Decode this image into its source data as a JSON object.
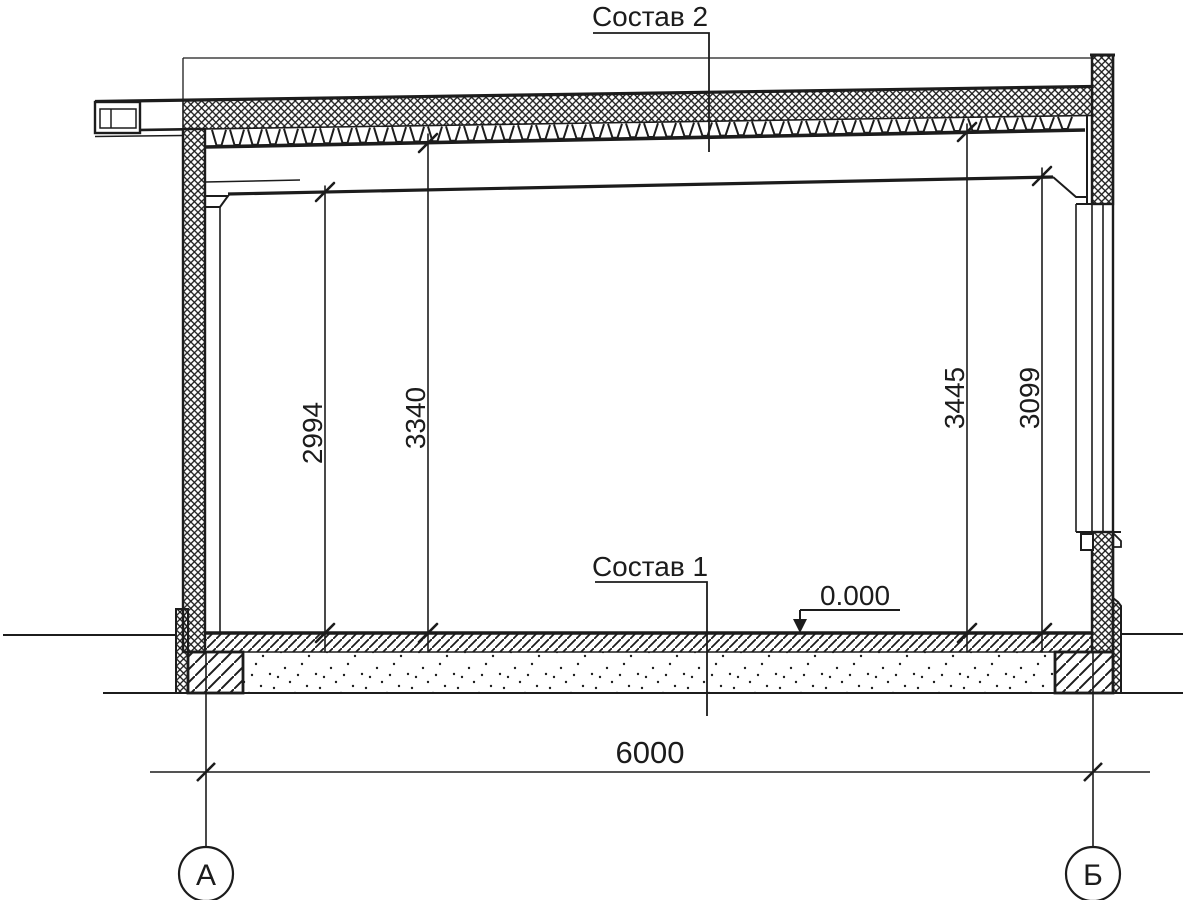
{
  "drawing": {
    "type": "building-section",
    "callouts": {
      "roof_assembly": "Состав 2",
      "floor_assembly": "Состав 1"
    },
    "level_mark": {
      "value": "0.000"
    },
    "dimensions": {
      "overall_width": {
        "value": "6000"
      },
      "vertical": [
        {
          "value": "2994"
        },
        {
          "value": "3340"
        },
        {
          "value": "3445"
        },
        {
          "value": "3099"
        }
      ]
    },
    "axes": {
      "left": "А",
      "right": "Б"
    },
    "colors": {
      "ink": "#1c1c1c",
      "background": "#ffffff"
    }
  }
}
